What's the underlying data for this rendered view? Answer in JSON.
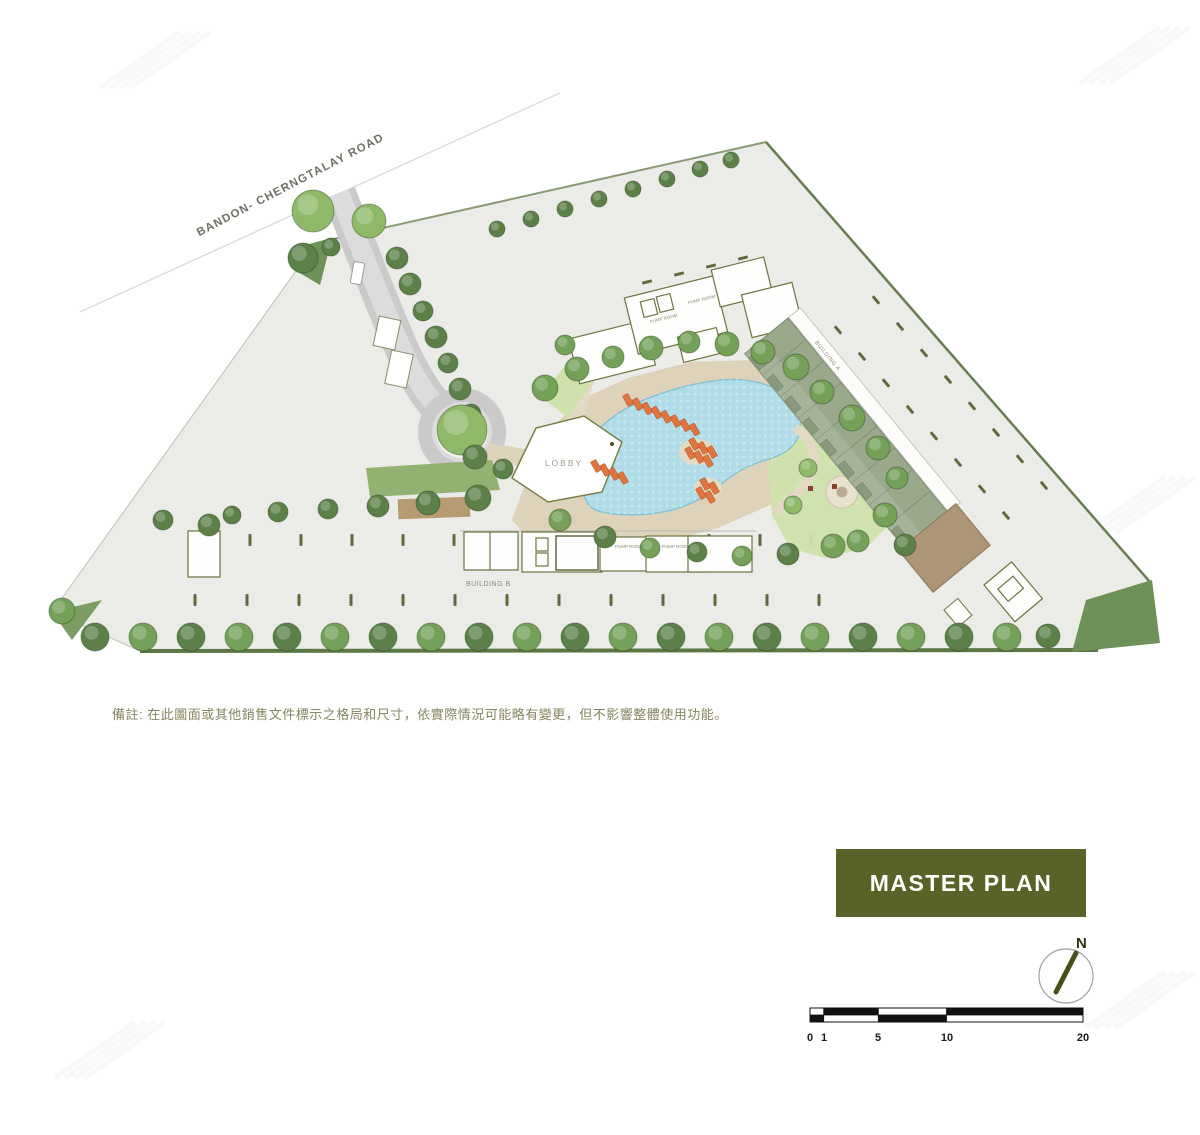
{
  "plan": {
    "road_label": "BANDON- CHERNGTALAY ROAD",
    "lobby_label": "LOBBY",
    "building_a_label": "BUILDING A",
    "building_b_label": "BUILDING B",
    "pump_room_label": "PUMP ROOM"
  },
  "note": {
    "text": "備註: 在此圖面或其他銷售文件標示之格局和尺寸，依實際情況可能略有變更，但不影響整體使用功能。"
  },
  "title": {
    "label": "MASTER PLAN",
    "bg_color": "#5a6227",
    "text_color": "#ffffff"
  },
  "compass": {
    "north_label": "N"
  },
  "scale_bar": {
    "labels": [
      "0",
      "1",
      "5",
      "10",
      "20"
    ]
  },
  "colors": {
    "site_ground": "#ebece8",
    "boundary_green": "#6a7d52",
    "corner_green": "#6e9158",
    "road_gray": "#cbcbcb",
    "deck_beige": "#ded2ba",
    "pool_blue": "#b2dde8",
    "tree_green": "#74a057",
    "roof_sage": "#9aa88c",
    "olive_outline": "#6d7340",
    "note_text": "#85855f"
  }
}
